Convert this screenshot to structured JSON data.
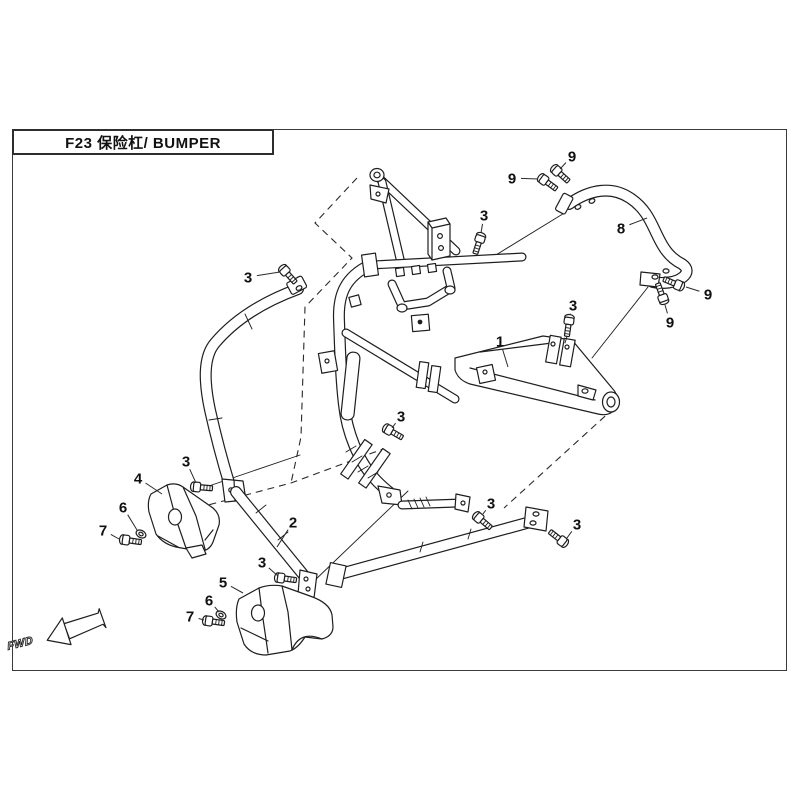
{
  "page": {
    "background": "#ffffff",
    "line_color": "#1e1e1e",
    "border_color": "#3a3a3a"
  },
  "title_box": {
    "text": "F23  保险杠/ BUMPER"
  },
  "fwd_marker": {
    "label": "FWD"
  },
  "diagram": {
    "callouts": [
      {
        "label": "3",
        "x": 248,
        "y": 277,
        "tx": 280,
        "ty": 272
      },
      {
        "label": "9",
        "x": 572,
        "y": 156,
        "tx": 560,
        "ty": 169
      },
      {
        "label": "9",
        "x": 512,
        "y": 178,
        "tx": 538,
        "ty": 179
      },
      {
        "label": "8",
        "x": 621,
        "y": 228,
        "tx": 647,
        "ty": 218
      },
      {
        "label": "3",
        "x": 484,
        "y": 215,
        "tx": 481,
        "ty": 233
      },
      {
        "label": "9",
        "x": 708,
        "y": 294,
        "tx": 686,
        "ty": 287
      },
      {
        "label": "9",
        "x": 670,
        "y": 322,
        "tx": 665,
        "ty": 305
      },
      {
        "label": "3",
        "x": 573,
        "y": 305,
        "tx": 570,
        "ty": 315
      },
      {
        "label": "1",
        "x": 500,
        "y": 341,
        "tx": 508,
        "ty": 367
      },
      {
        "label": "3",
        "x": 401,
        "y": 416,
        "tx": 392,
        "ty": 428
      },
      {
        "label": "3",
        "x": 186,
        "y": 461,
        "tx": 196,
        "ty": 483
      },
      {
        "label": "4",
        "x": 138,
        "y": 478,
        "tx": 162,
        "ty": 494
      },
      {
        "label": "6",
        "x": 123,
        "y": 507,
        "tx": 137,
        "ty": 530
      },
      {
        "label": "7",
        "x": 103,
        "y": 530,
        "tx": 119,
        "ty": 539
      },
      {
        "label": "2",
        "x": 293,
        "y": 522,
        "tx": 277,
        "ty": 547
      },
      {
        "label": "3",
        "x": 491,
        "y": 503,
        "tx": 483,
        "ty": 514
      },
      {
        "label": "3",
        "x": 577,
        "y": 524,
        "tx": 567,
        "ty": 538
      },
      {
        "label": "3",
        "x": 262,
        "y": 562,
        "tx": 278,
        "ty": 576
      },
      {
        "label": "5",
        "x": 223,
        "y": 582,
        "tx": 243,
        "ty": 593
      },
      {
        "label": "6",
        "x": 209,
        "y": 600,
        "tx": 219,
        "ty": 612
      },
      {
        "label": "7",
        "x": 190,
        "y": 616,
        "tx": 204,
        "ty": 620
      }
    ],
    "hardware": {
      "bolts": [
        {
          "x": 285,
          "y": 271,
          "rot": 48
        },
        {
          "x": 480,
          "y": 239,
          "rot": 108
        },
        {
          "x": 557,
          "y": 171,
          "rot": 42
        },
        {
          "x": 544,
          "y": 180,
          "rot": 36
        },
        {
          "x": 678,
          "y": 285,
          "rot": 203
        },
        {
          "x": 663,
          "y": 298,
          "rot": 250
        },
        {
          "x": 569,
          "y": 321,
          "rot": 98
        },
        {
          "x": 389,
          "y": 430,
          "rot": 30
        },
        {
          "x": 197,
          "y": 487,
          "rot": 5
        },
        {
          "x": 281,
          "y": 578,
          "rot": 8
        },
        {
          "x": 479,
          "y": 518,
          "rot": 40
        },
        {
          "x": 562,
          "y": 541,
          "rot": 218
        },
        {
          "x": 126,
          "y": 540,
          "rot": 8
        },
        {
          "x": 209,
          "y": 621,
          "rot": 8
        }
      ],
      "washers": [
        {
          "x": 141,
          "y": 534,
          "rot": 28
        },
        {
          "x": 221,
          "y": 615,
          "rot": 28
        }
      ]
    }
  }
}
